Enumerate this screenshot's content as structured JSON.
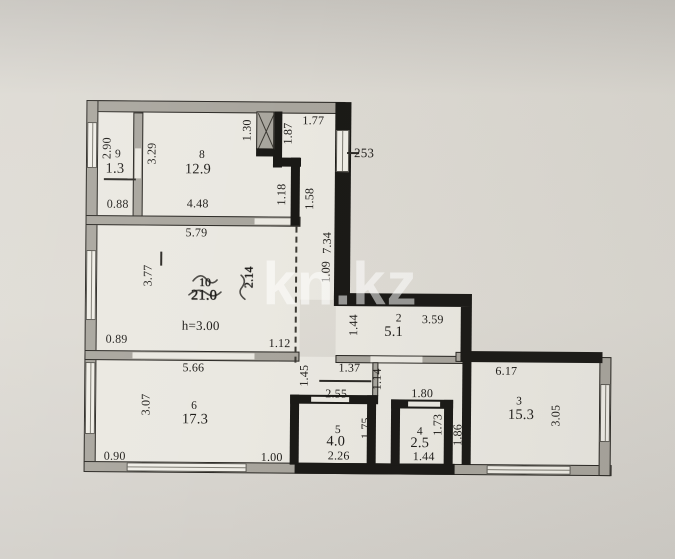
{
  "watermark": "kn.kz",
  "colors": {
    "paper": "#dedbd4",
    "ink": "#1e1c19",
    "wall_gray": "#a8a59d",
    "wall_black": "#1a1916",
    "room_fill": "#eae8e1",
    "watermark": "rgba(255,255,255,0.55)"
  },
  "plan": {
    "ceiling_height_note": "h=3.00",
    "window_marker": "253",
    "rooms": [
      {
        "number": "9",
        "area": "1.3"
      },
      {
        "number": "8",
        "area": "12.9"
      },
      {
        "number": "10",
        "area": "21.0"
      },
      {
        "number": "2",
        "area": "5.1"
      },
      {
        "number": "6",
        "area": "17.3"
      },
      {
        "number": "5",
        "area": "4.0"
      },
      {
        "number": "4",
        "area": "2.5"
      },
      {
        "number": "3",
        "area": "15.3"
      }
    ]
  },
  "labels": [
    {
      "text": "2.90",
      "x": 106,
      "y": 150,
      "rot": -90,
      "kind": "dim"
    },
    {
      "text": "3.29",
      "x": 151,
      "y": 155,
      "rot": -90,
      "kind": "dim"
    },
    {
      "text": "9",
      "x": 117,
      "y": 156,
      "kind": "num"
    },
    {
      "text": "1.3",
      "x": 114,
      "y": 171,
      "kind": "area"
    },
    {
      "text": "0.88",
      "x": 117,
      "y": 206,
      "kind": "dim"
    },
    {
      "text": "8",
      "x": 201,
      "y": 156,
      "kind": "num"
    },
    {
      "text": "12.9",
      "x": 197,
      "y": 171,
      "kind": "area"
    },
    {
      "text": "4.48",
      "x": 197,
      "y": 205,
      "kind": "dim"
    },
    {
      "text": "5.79",
      "x": 196,
      "y": 234,
      "kind": "dim"
    },
    {
      "text": "1.30",
      "x": 246,
      "y": 131,
      "rot": -90,
      "kind": "dim"
    },
    {
      "text": "1.87",
      "x": 287,
      "y": 134,
      "rot": -90,
      "kind": "dim"
    },
    {
      "text": "1.77",
      "x": 312,
      "y": 121,
      "kind": "dim"
    },
    {
      "text": "253",
      "x": 363,
      "y": 153,
      "kind": "note"
    },
    {
      "text": "1.18",
      "x": 281,
      "y": 195,
      "rot": -90,
      "kind": "dim"
    },
    {
      "text": "1.58",
      "x": 309,
      "y": 199,
      "rot": -90,
      "kind": "dim"
    },
    {
      "text": "7.34",
      "x": 327,
      "y": 243,
      "rot": -90,
      "kind": "dim"
    },
    {
      "text": "1.09",
      "x": 326,
      "y": 272,
      "rot": -90,
      "kind": "dim"
    },
    {
      "text": "3.77",
      "x": 148,
      "y": 277,
      "rot": -90,
      "kind": "dim"
    },
    {
      "text": "10",
      "x": 205,
      "y": 284,
      "kind": "num",
      "scribble": true
    },
    {
      "text": "21.0",
      "x": 204,
      "y": 297,
      "kind": "area",
      "scribble": true
    },
    {
      "text": "2.14",
      "x": 249,
      "y": 278,
      "rot": -90,
      "kind": "dim",
      "scribble": true
    },
    {
      "text": "h=3.00",
      "x": 201,
      "y": 327,
      "kind": "note"
    },
    {
      "text": "0.89",
      "x": 117,
      "y": 341,
      "kind": "dim"
    },
    {
      "text": "1.12",
      "x": 280,
      "y": 344,
      "kind": "dim"
    },
    {
      "text": "5.66",
      "x": 194,
      "y": 369,
      "kind": "dim"
    },
    {
      "text": "1.44",
      "x": 354,
      "y": 325,
      "rot": -90,
      "kind": "dim"
    },
    {
      "text": "2",
      "x": 399,
      "y": 318,
      "kind": "num"
    },
    {
      "text": "5.1",
      "x": 394,
      "y": 332,
      "kind": "area"
    },
    {
      "text": "3.59",
      "x": 433,
      "y": 319,
      "kind": "dim"
    },
    {
      "text": "1.45",
      "x": 305,
      "y": 376,
      "rot": -90,
      "kind": "dim"
    },
    {
      "text": "1.37",
      "x": 350,
      "y": 368,
      "kind": "dim"
    },
    {
      "text": "1.14",
      "x": 378,
      "y": 379,
      "rot": -90,
      "kind": "dim"
    },
    {
      "text": "2.55",
      "x": 337,
      "y": 394,
      "kind": "dim"
    },
    {
      "text": "1.80",
      "x": 423,
      "y": 393,
      "kind": "dim"
    },
    {
      "text": "6.17",
      "x": 507,
      "y": 370,
      "kind": "dim"
    },
    {
      "text": "3.07",
      "x": 147,
      "y": 406,
      "rot": -90,
      "kind": "dim"
    },
    {
      "text": "6",
      "x": 195,
      "y": 407,
      "kind": "num"
    },
    {
      "text": "17.3",
      "x": 196,
      "y": 421,
      "kind": "area"
    },
    {
      "text": "0.90",
      "x": 116,
      "y": 458,
      "kind": "dim"
    },
    {
      "text": "1.00",
      "x": 273,
      "y": 458,
      "kind": "dim"
    },
    {
      "text": "5",
      "x": 339,
      "y": 430,
      "kind": "num"
    },
    {
      "text": "4.0",
      "x": 337,
      "y": 442,
      "kind": "area"
    },
    {
      "text": "2.26",
      "x": 340,
      "y": 456,
      "kind": "dim"
    },
    {
      "text": "1.75",
      "x": 367,
      "y": 428,
      "rot": -90,
      "kind": "dim"
    },
    {
      "text": "4",
      "x": 421,
      "y": 431,
      "kind": "num"
    },
    {
      "text": "2.5",
      "x": 421,
      "y": 443,
      "kind": "area"
    },
    {
      "text": "1.44",
      "x": 425,
      "y": 456,
      "kind": "dim"
    },
    {
      "text": "1.73",
      "x": 439,
      "y": 424,
      "rot": -90,
      "kind": "dim"
    },
    {
      "text": "1.86",
      "x": 459,
      "y": 434,
      "rot": -90,
      "kind": "dim"
    },
    {
      "text": "3",
      "x": 520,
      "y": 400,
      "kind": "num"
    },
    {
      "text": "15.3",
      "x": 522,
      "y": 414,
      "kind": "area"
    },
    {
      "text": "3.05",
      "x": 557,
      "y": 414,
      "rot": -90,
      "kind": "dim"
    }
  ]
}
